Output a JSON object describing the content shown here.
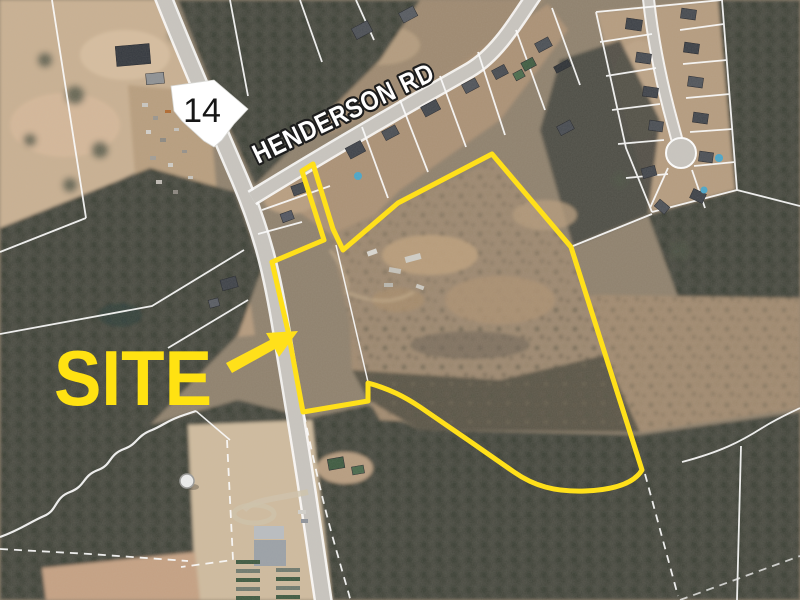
{
  "annotations": {
    "site_label": "SITE",
    "road_label": "HENDERSON RD",
    "route_shield_number": "14",
    "site_boundary_path": "M302,171 L313,164 L333,229 L343,250 L398,203 L492,154 L571,247 L642,470 C633,485 610,490 585,491 C555,492 534,486 514,472 C487,453 445,424 420,407 C405,397 390,389 368,383 L368,401 L303,412 L288,331 L272,262 L324,240 Z",
    "arrow_points": "298,331 266,333 270,340 226,363 232,373 275,349 279,357",
    "shield_points": "171,86 214,80 248,109 234,124 222,140 214,147 204,141 193,131 182,121 174,111",
    "colors": {
      "boundary_yellow": "#ffe01a",
      "label_yellow": "#ffe212",
      "road_label_fill": "#ffffff",
      "road_label_outline": "#1c1c1c",
      "shield_fill": "#ffffff",
      "shield_text": "#161616",
      "parcel_line": "#ffffff"
    }
  }
}
